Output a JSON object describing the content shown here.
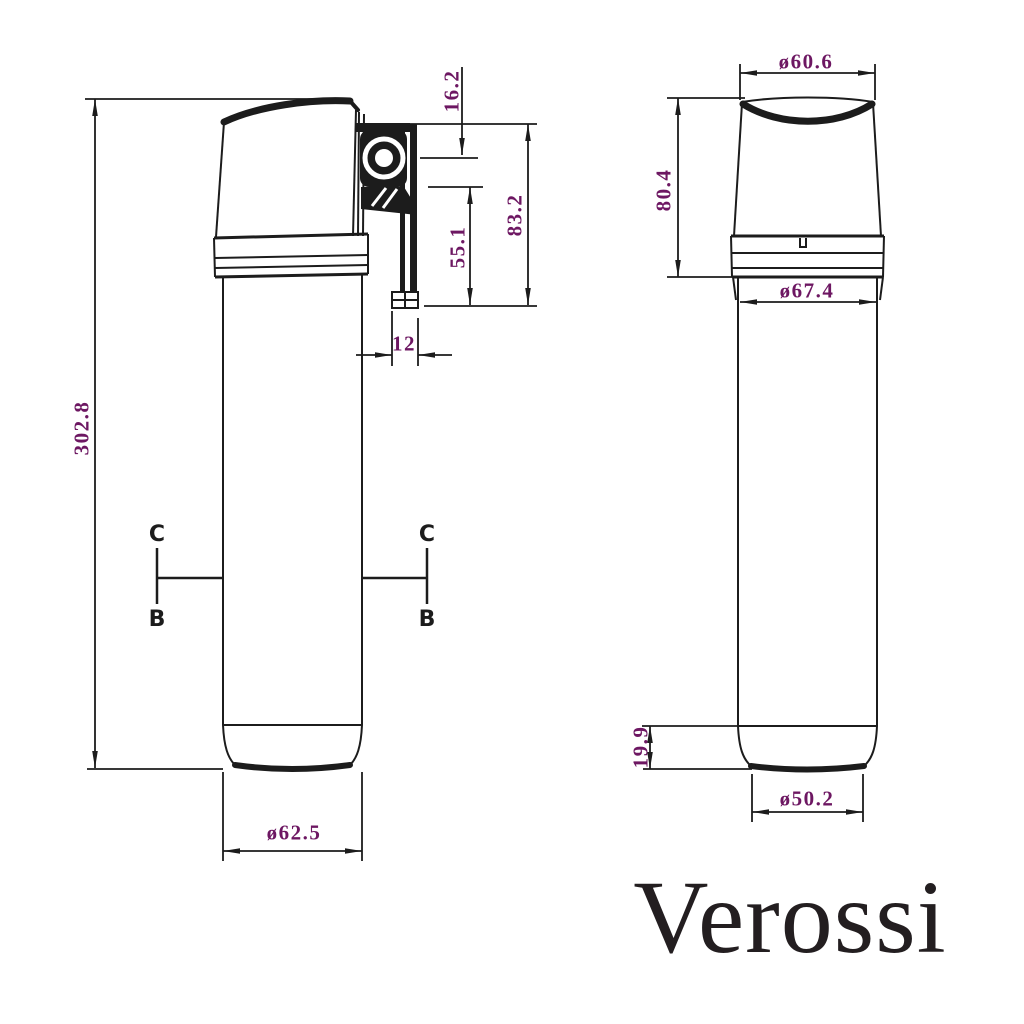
{
  "drawing": {
    "brand": "Verossi",
    "colors": {
      "dimension_text": "#6d1762",
      "linework": "#1c1c1c",
      "brand_text": "#231e20"
    },
    "side_view": {
      "overall_height": "302.8",
      "pivot_offset": "16.2",
      "bracket_overall_height": "83.2",
      "bracket_lower_height": "55.1",
      "bracket_width": "12",
      "base_diameter": "ø62.5",
      "section_markers": {
        "left_top": "C",
        "left_bottom": "B",
        "right_top": "C",
        "right_bottom": "B"
      }
    },
    "front_view": {
      "top_diameter": "ø60.6",
      "head_height": "80.4",
      "collar_diameter": "ø67.4",
      "base_ring_height": "19.9",
      "base_diameter": "ø50.2"
    }
  }
}
